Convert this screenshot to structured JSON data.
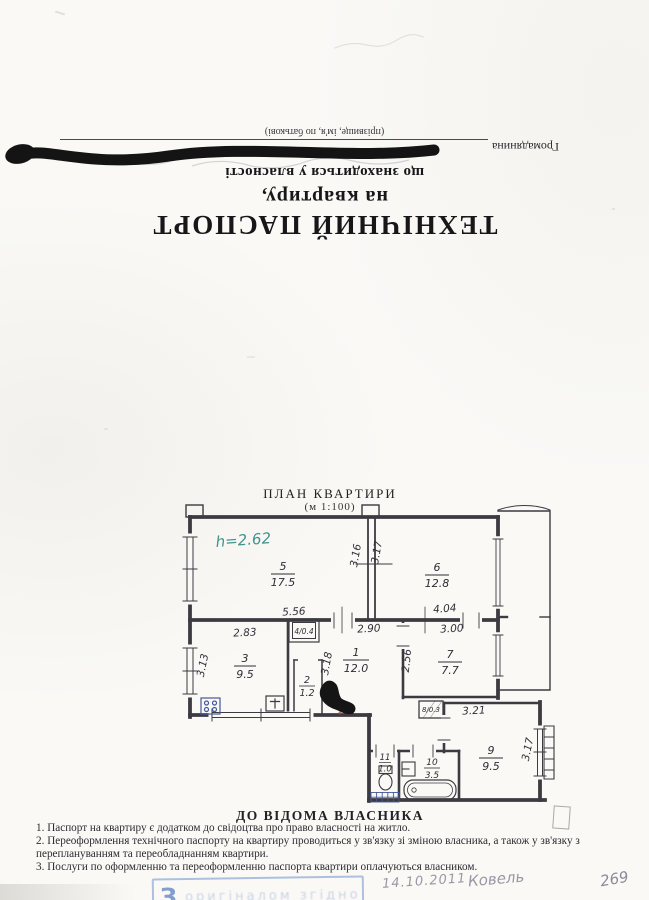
{
  "document": {
    "header": {
      "title": "ТЕХНІЧНИЙ ПАСПОРТ",
      "line2": "на квартиру,",
      "line3": "що знаходиться у власності",
      "owner_label": "Громадянина",
      "owner_hint": "(прізвище, ім'я, по батькові)"
    },
    "plan": {
      "title": "ПЛАН КВАРТИРИ",
      "scale": "(м 1:100)",
      "ceiling_height": "h=2.62",
      "rooms": [
        {
          "num": "1",
          "area": "12.0"
        },
        {
          "num": "2",
          "area": "1.2"
        },
        {
          "num": "3",
          "area": "9.5"
        },
        {
          "num": "4",
          "area": "0.4",
          "label": "4/0.4"
        },
        {
          "num": "5",
          "area": "17.5"
        },
        {
          "num": "6",
          "area": "12.8"
        },
        {
          "num": "7",
          "area": "7.7"
        },
        {
          "num": "8",
          "area": "0.3",
          "label": "8/0.3"
        },
        {
          "num": "9",
          "area": "9.5"
        },
        {
          "num": "10",
          "area": "3.5"
        },
        {
          "num": "11",
          "area": "1.0"
        }
      ],
      "dims": {
        "w556": "5.56",
        "w283": "2.83",
        "w290": "2.90",
        "w404": "4.04",
        "w300": "3.00",
        "w321": "3.21",
        "h316": "3.16",
        "h317a": "3.17",
        "h313": "3.13",
        "h318": "3.18",
        "h256": "2.56",
        "h317b": "3.17"
      }
    },
    "notice": {
      "heading": "ДО ВІДОМА ВЛАСНИКА",
      "items": [
        "1. Паспорт на квартиру є додатком до свідоцтва про право власності на житло.",
        "2. Переоформлення технічного паспорту на квартиру проводиться у зв'язку зі зміною власника, а також у зв'язку з переплануванням та переобладнанням квартири.",
        "3. Послуги по оформленню  та переоформленню паспорта квартири оплачуються власником."
      ]
    },
    "annotations": {
      "stamp_letter": "З",
      "stamp_text": "оригіналом згідно",
      "date": "14.10.2011",
      "signature": "Ковель",
      "page_number": "269"
    }
  }
}
